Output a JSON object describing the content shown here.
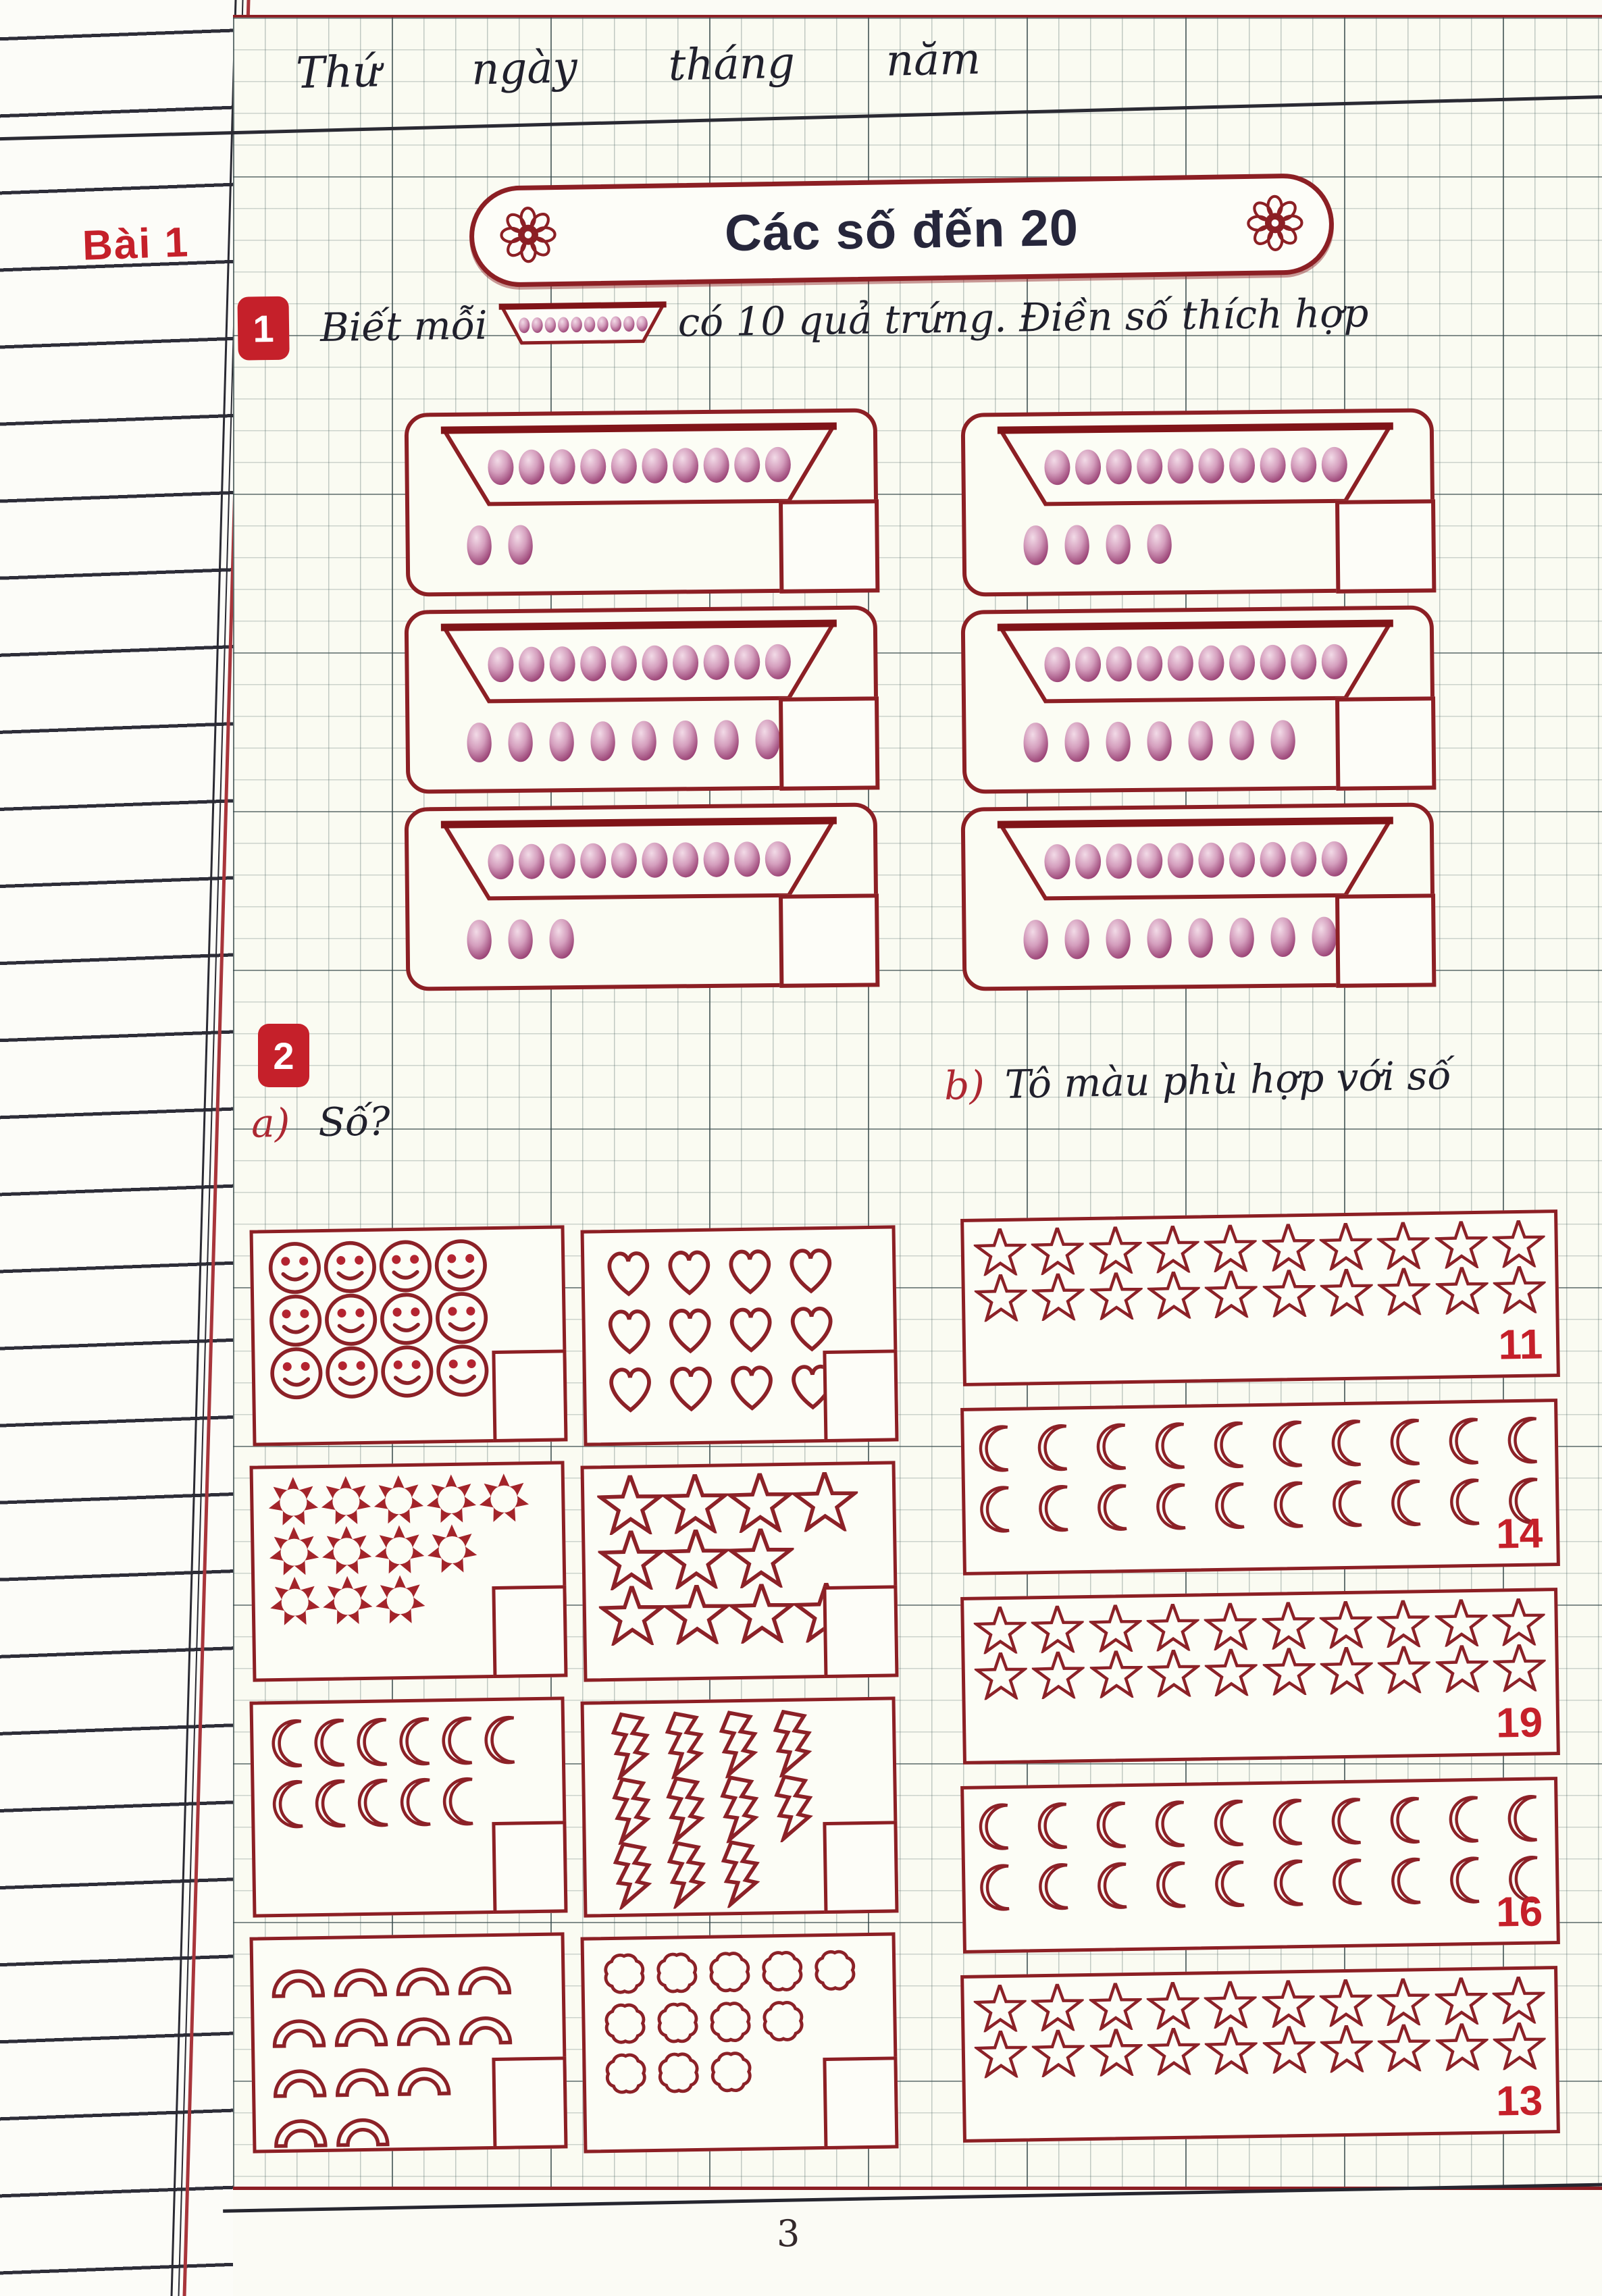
{
  "page": {
    "number": "3"
  },
  "header": {
    "words": [
      "Thứ",
      "ngày",
      "tháng",
      "năm"
    ]
  },
  "lesson_tab": "Bài 1",
  "title_banner": {
    "text": "Các số đến 20",
    "flower_icon": "flower"
  },
  "exercise1": {
    "badge": "1",
    "prompt_before": "Biết mỗi",
    "prompt_after": "có 10 quả trứng. Điền số thích hợp",
    "tray_capacity": 10,
    "egg_boxes": [
      {
        "trays": 1,
        "loose_eggs": 2
      },
      {
        "trays": 1,
        "loose_eggs": 4
      },
      {
        "trays": 1,
        "loose_eggs": 9
      },
      {
        "trays": 1,
        "loose_eggs": 7
      },
      {
        "trays": 1,
        "loose_eggs": 3
      },
      {
        "trays": 1,
        "loose_eggs": 8
      }
    ]
  },
  "exercise2": {
    "badge": "2",
    "part_a_label": "a)",
    "part_a_title": "Số?",
    "part_b_label": "b)",
    "part_b_title": "Tô màu phù hợp với số",
    "count_boxes": [
      {
        "shape": "smiley",
        "rows": [
          4,
          4,
          4
        ]
      },
      {
        "shape": "heart",
        "rows": [
          4,
          4,
          4
        ]
      },
      {
        "shape": "sun",
        "rows": [
          5,
          4,
          3
        ]
      },
      {
        "shape": "star",
        "rows": [
          4,
          3,
          4
        ]
      },
      {
        "shape": "moon",
        "rows": [
          6,
          5
        ]
      },
      {
        "shape": "lightning",
        "rows": [
          4,
          4,
          3
        ]
      },
      {
        "shape": "rainbow",
        "rows": [
          4,
          4,
          3,
          2
        ]
      },
      {
        "shape": "cloud",
        "rows": [
          5,
          4,
          3
        ]
      }
    ],
    "color_boxes": [
      {
        "shape": "star",
        "rows": [
          10,
          10
        ],
        "number": "11"
      },
      {
        "shape": "moon",
        "rows": [
          10,
          10
        ],
        "number": "14"
      },
      {
        "shape": "star",
        "rows": [
          10,
          10
        ],
        "number": "19"
      },
      {
        "shape": "moon",
        "rows": [
          10,
          10
        ],
        "number": "16"
      },
      {
        "shape": "star",
        "rows": [
          10,
          10
        ],
        "number": "13"
      }
    ]
  },
  "colors": {
    "maroon_border": "#8c1f24",
    "red_accent": "#c5202a",
    "ink": "#20202c",
    "banner_text": "#26263b",
    "egg_dark": "#8e2f66",
    "egg_light": "#f2dbe7"
  }
}
